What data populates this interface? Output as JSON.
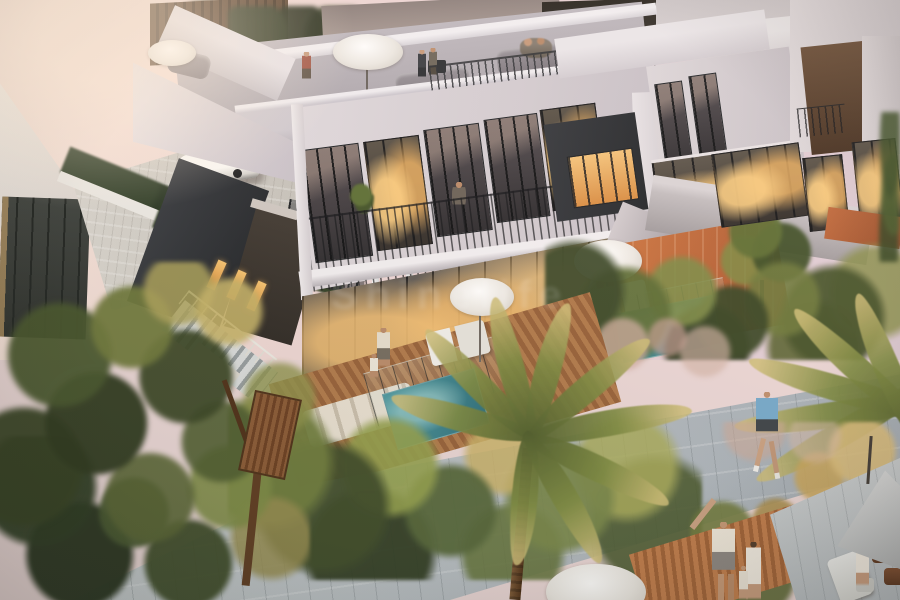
{
  "scene": {
    "type": "real-estate-architectural-render",
    "setting": "Aerial dusk view of a modern two-storey villa community with rooftop terraces, warmly lit floor-to-ceiling windows, private plunge pools, timber decks, landscaped gardens, palm trees and a stone jogging path",
    "time_of_day": "dusk"
  },
  "watermark": {
    "text": "Shinelife",
    "style": "faint semi-transparent white, center of image"
  },
  "palette": {
    "sky_pink": "#f0dad6",
    "wall_light": "#d9d4d9",
    "wall_white": "#efedf1",
    "wall_dark_charcoal": "#2f3338",
    "window_glow_amber": "#f2b05e",
    "terracotta_patio": "#c06a3e",
    "pool_teal": "#3f8d96",
    "foliage_green": "#55663a",
    "foliage_gold": "#c9b269",
    "path_gray": "#b9c0c6",
    "deck_wood": "#a86f45"
  },
  "objects": [
    "two-storey modern villas with stepped white parapets",
    "rooftop terrace with standing figures, grey sofas, barbecue and white patio umbrellas",
    "upper-floor balcony with glass doors, dark railing, potted plants and a woman in a green dress",
    "ground-floor glass walls with warm interior lighting",
    "private plunge pools with glass pool fencing",
    "timber pool decks with white sun loungers and parasols",
    "terracotta courtyard patio of the neighbouring villa",
    "white car parked on a paver driveway beside a hedge and dark metal gate",
    "external stair with white balustrade descending to the garden",
    "large canopy tree and dense shrub beds with golden ornamental grasses",
    "tall palm trees in the foreground",
    "curved stone jogging path with a runner in a blue shirt",
    "family of three walking on a timber boardwalk",
    "outdoor seating area with grey cantilever parasol, chairs and a standing woman"
  ]
}
